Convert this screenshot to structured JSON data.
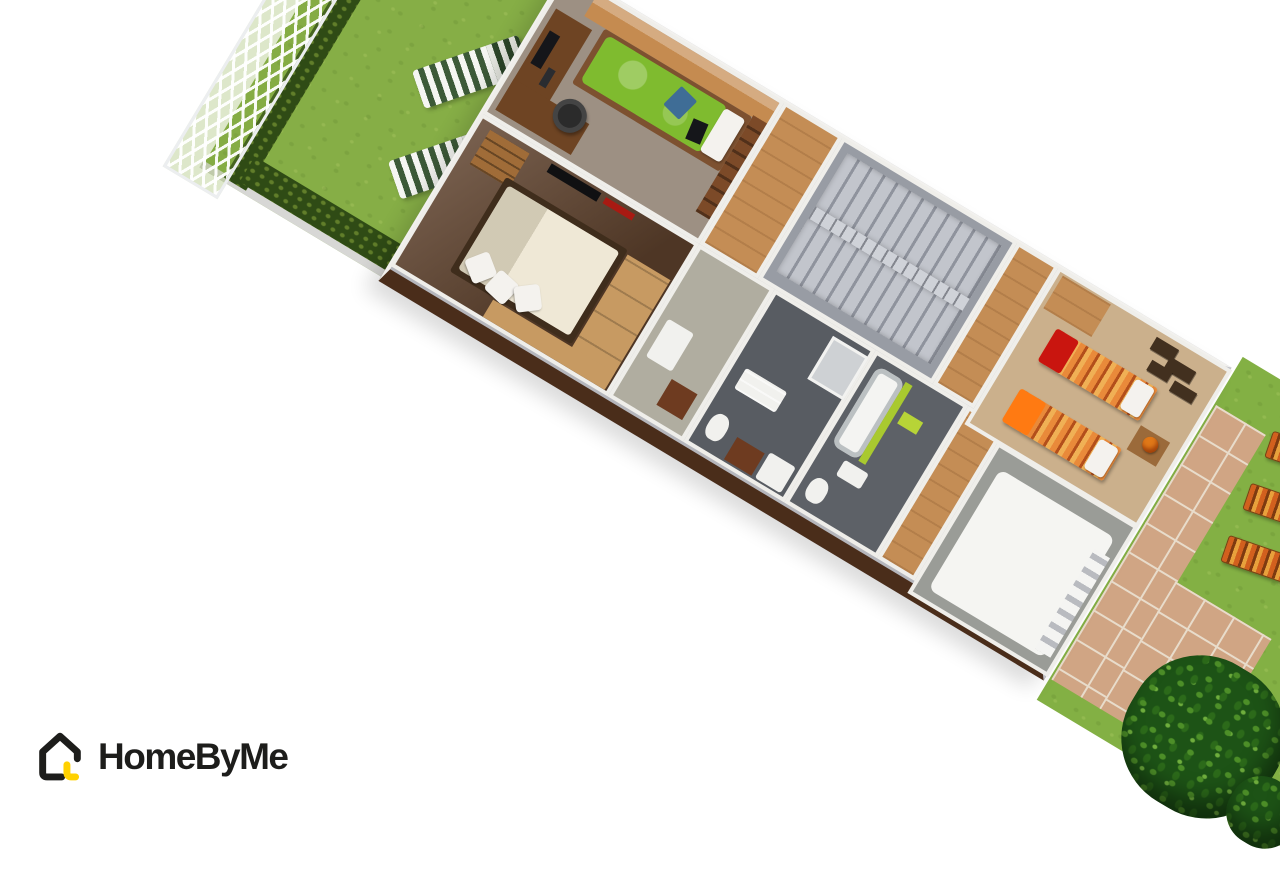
{
  "logo": {
    "text": "HomeByMe",
    "icon": "house-icon",
    "colors": {
      "outline": "#1d1d1b",
      "accent": "#ffd100",
      "text": "#1d1d1b"
    }
  },
  "scene": {
    "type": "3d-aerial-floorplan-render",
    "background": "#ffffff",
    "rooms": [
      {
        "name": "back-garden",
        "floor": "#86ae46"
      },
      {
        "name": "teen-bedroom",
        "floor": "#9d9083"
      },
      {
        "name": "master-bedroom",
        "floor": "#5f422d"
      },
      {
        "name": "entry-landing",
        "floor": "#c48d55"
      },
      {
        "name": "staircase",
        "floor": "#989ca4"
      },
      {
        "name": "hallway",
        "floor": "#b0ada0"
      },
      {
        "name": "shower-room",
        "floor": "#585c62"
      },
      {
        "name": "bathroom",
        "floor": "#5d6167"
      },
      {
        "name": "twin-bedroom",
        "floor": "#cbb08c"
      },
      {
        "name": "garage",
        "floor": "#9a9c97"
      },
      {
        "name": "front-yard",
        "floor": "#83b044"
      }
    ],
    "colors": {
      "grass_back": "#86ae46",
      "grass_front": "#83b044",
      "hedge": "#2f4b15",
      "curb": "#d7d7d5",
      "wall_gray": "#b5b6bc",
      "floor_study": "#9d9083",
      "floor_master": "#5f422d",
      "floor_twin": "#cbb08c",
      "floor_hall_wood": "#c48d55",
      "floor_hall_gray": "#b0ada0",
      "floor_bath": "#585c62",
      "floor_bath2": "#5d6167",
      "floor_garage": "#9a9c97",
      "garage_slab": "#f5f5f2",
      "stair_base": "#989ca4",
      "stair_rail": "#cfd2d8",
      "bed_green": "#7fbb2f",
      "bed_green_light": "#97cd4d",
      "bed_frame_wood": "#7d5130",
      "cabinet_wood": "#c58b50",
      "desk_wood": "#6e4423",
      "shelf_wood": "#7c4a28",
      "monitor_black": "#15161a",
      "chair_black": "#2b2b2b",
      "duvet_cream": "#efe8d6",
      "duvet_cream_dark": "#e2dac4",
      "bedframe_dark": "#3f2d1c",
      "wardrobe_wood": "#c79a62",
      "dresser_wood": "#a06c38",
      "tv_black": "#101012",
      "wall_art_red": "#a81a12",
      "blanket_red": "#c9150f",
      "blanket_orange": "#ff7a12",
      "pillow_white": "#f4f2ee",
      "nightstand_wood": "#9b6a3a",
      "lamp_orange": "#e07818",
      "shelves_dark": "#42301f",
      "tub_white": "#f4f4f2",
      "lime_green": "#a9c92f",
      "lime_green_light": "#b7d437",
      "shower_gray": "#ced1d4",
      "fixture_white": "#f1f1ee",
      "bath_cabinet": "#6e3b20",
      "tile_tan": "#d0a584",
      "tree_green": "#1d5316",
      "lounger_stripe_white": "#f5f6f2",
      "lounger_stripe_green": "#3c5a38",
      "deck_stripe_orange": "#d2601e",
      "exterior_wall_dark": "#4a2d1a"
    }
  }
}
